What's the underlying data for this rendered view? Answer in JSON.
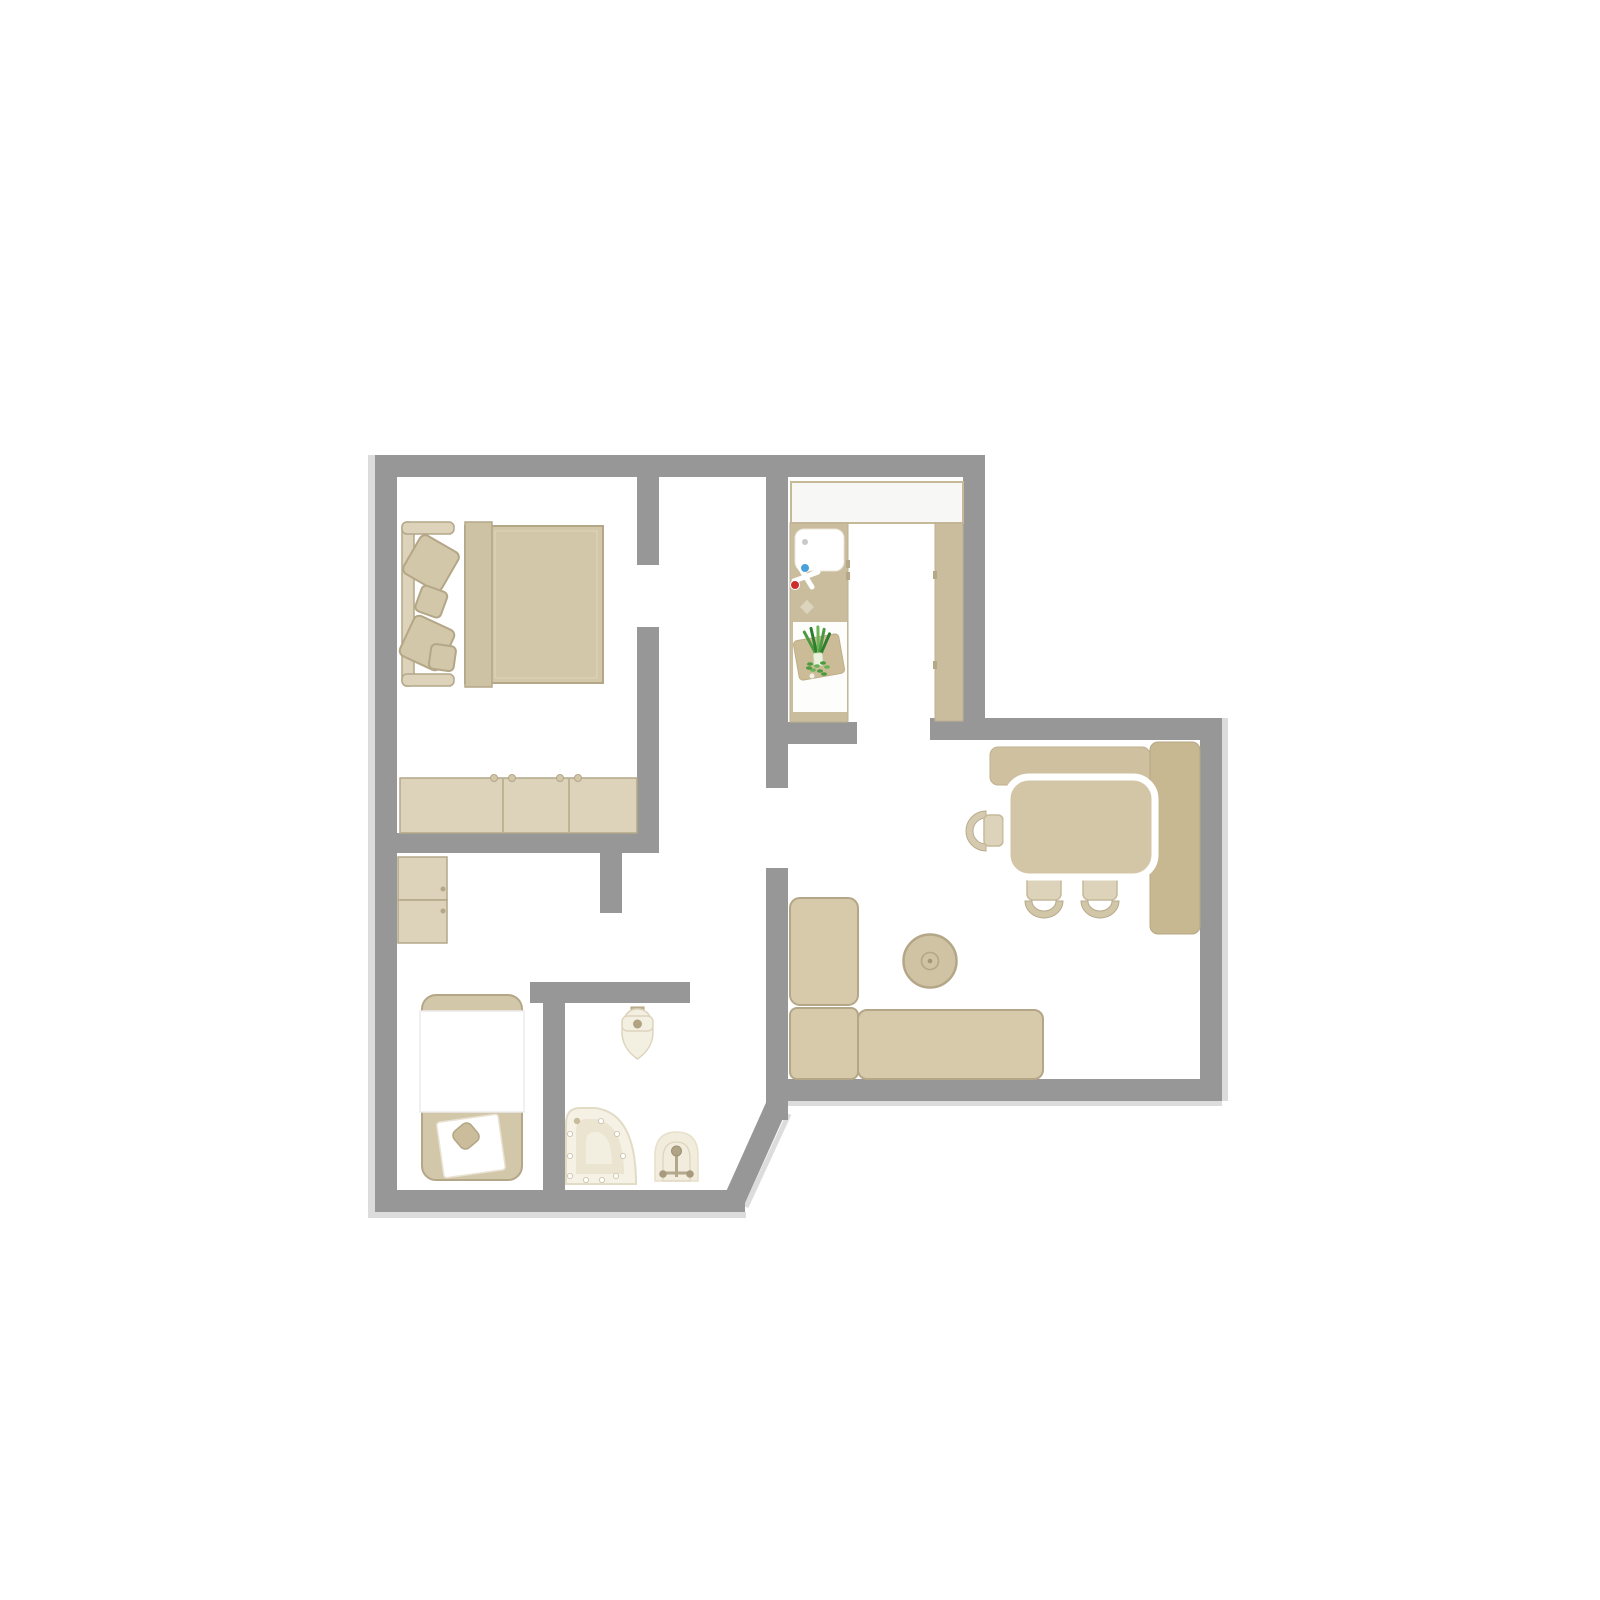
{
  "canvas": {
    "width": 1600,
    "height": 1600
  },
  "colors": {
    "background": "#ffffff",
    "wall": "#979797",
    "wall_shadow": "#dcdcdc",
    "furniture": "#d2c7a9",
    "furniture_light": "#ddd3bb",
    "furniture_dark": "#cdc2a4",
    "furniture_border": "#b4a788",
    "sofa": "#d6caab",
    "counter": "#cabd9e",
    "counter_border": "#bdb092",
    "bench_top": "#cfc1a0",
    "bench_right": "#c7b892",
    "table": "#d3c6a7",
    "panel": "#f7f8f5",
    "cream": "#f3efe1",
    "cream_mid": "#ebe4d0",
    "cream_border": "#ddd4bd",
    "fixture_metal": "#b4a88c",
    "fixture_dot": "#a89b7d",
    "green": "#4c9a40",
    "green_dark": "#2f7d2e",
    "green_light": "#6ab656",
    "red": "#cc2d2d",
    "blue": "#4aa0d8",
    "gray_dot": "#c9c9c9",
    "white": "#ffffff"
  },
  "floorplan": {
    "rooms": [
      {
        "name": "bedroom",
        "furniture": [
          "double-bed",
          "headboard-bench",
          "pillows",
          "dresser"
        ]
      },
      {
        "name": "hallway",
        "furniture": []
      },
      {
        "name": "kitchen",
        "furniture": [
          "upper-panel",
          "counter-with-sink",
          "faucet",
          "cutting-board-with-leek",
          "tall-cabinet"
        ]
      },
      {
        "name": "dining-living-room",
        "furniture": [
          "corner-bench",
          "dining-table",
          "side-chair",
          "two-chairs",
          "ottoman",
          "corner-sofa"
        ]
      },
      {
        "name": "small-room",
        "furniture": [
          "cabinet",
          "daybed",
          "pillow"
        ]
      },
      {
        "name": "bathroom",
        "furniture": [
          "toilet",
          "corner-shower",
          "washbasin"
        ]
      }
    ]
  }
}
